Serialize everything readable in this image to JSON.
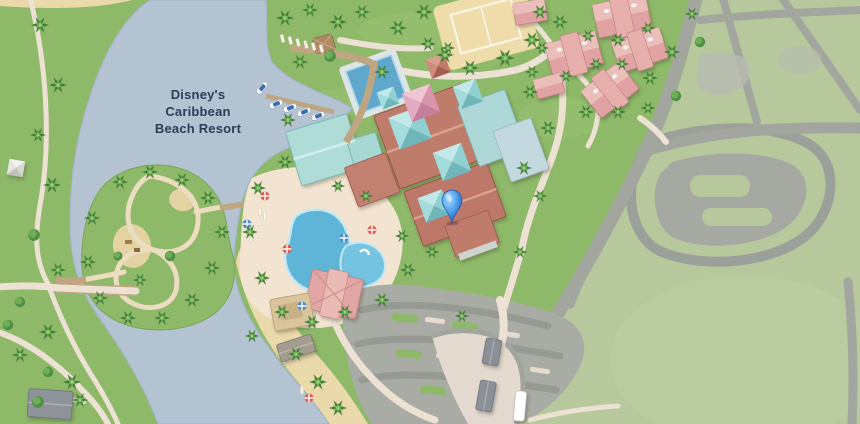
{
  "map": {
    "label": {
      "full": "Disney's Caribbean Beach Resort",
      "line1": "Disney's",
      "line2": "Caribbean",
      "line3": "Beach Resort"
    },
    "pin": {
      "icon": "location-pin-icon",
      "color": "#2b79d6"
    },
    "palette": {
      "water": "#b3c3d2",
      "land": "#8eb968",
      "lawn": "#b6c89c",
      "sand": "#ecdaac",
      "path": "#ece1d3",
      "road": "#a3a69e",
      "parking": "#a9aca4",
      "roof_terracotta": "#c07b6b",
      "roof_pink": "#e0a2a2",
      "roof_teal": "#97d4d5",
      "pool": "#5fb5d8",
      "label_text": "#2c3e54"
    }
  }
}
